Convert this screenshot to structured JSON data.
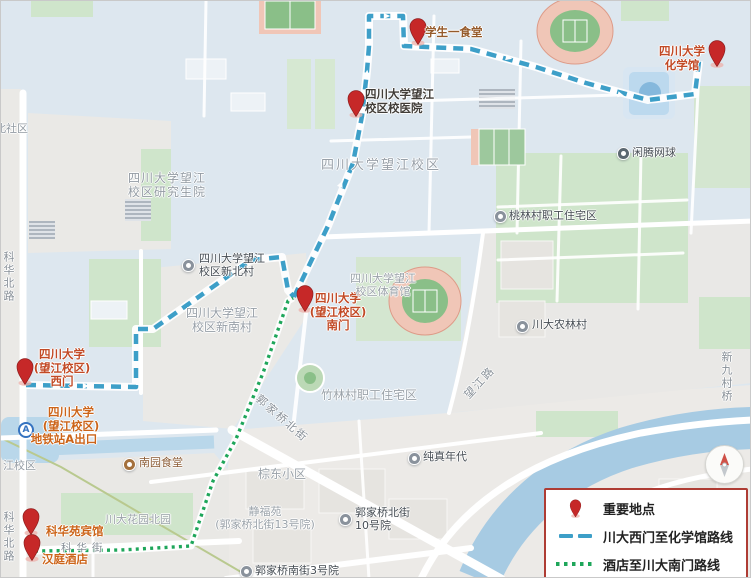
{
  "colors": {
    "route_blue": "#3d9fc8",
    "route_green": "#1ea65a",
    "pin_red": "#c62828",
    "legend_border": "#ae3c34",
    "water": "#a7cbe3",
    "green_area": "#cfe5cb",
    "campus_bg": "#dde7ef"
  },
  "legend": {
    "items": [
      {
        "label": "重要地点"
      },
      {
        "label": "川大西门至化学馆路线"
      },
      {
        "label": "酒店至川大南门路线"
      }
    ]
  },
  "pins": {
    "canteen": {
      "label": "学生一食堂"
    },
    "chemistry": {
      "line1": "四川大学",
      "line2": "化学馆"
    },
    "hospital": {
      "line1": "四川大学望江",
      "line2": "校区校医院"
    },
    "south_gate": {
      "line1": "四川大学",
      "line2": "(望江校区)",
      "line3": "南门"
    },
    "west_gate": {
      "line1": "四川大学",
      "line2": "(望江校区)",
      "line3": "西门"
    },
    "kehuayuan_hotel": {
      "label": "科华苑宾馆"
    },
    "hanting_hotel": {
      "label": "汉庭酒店"
    }
  },
  "metro": {
    "badge": "A",
    "line1": "四川大学",
    "line2": "(望江校区)",
    "line3": "地铁站A出口"
  },
  "poi": {
    "xinbeicun": {
      "line1": "四川大学望江",
      "line2": "校区新北村"
    },
    "taolincun": {
      "label": "桃林村职工住宅区"
    },
    "xianteng": {
      "label": "闲腾网球"
    },
    "nonglincun": {
      "label": "川大农林村"
    },
    "chunzhen": {
      "label": "纯真年代"
    },
    "shihaoyuan": {
      "line1": "郭家桥北街",
      "line2": "10号院"
    },
    "sanhaoyuan": {
      "label": "郭家桥南街3号院"
    },
    "nanyuan": {
      "label": "南园食堂"
    }
  },
  "areas": {
    "graduate": {
      "line1": "四川大学望江",
      "line2": "校区研究生院"
    },
    "campus": {
      "label": "四川大学望江校区"
    },
    "xinnancun": {
      "line1": "四川大学望江",
      "line2": "校区新南村"
    },
    "gym": {
      "line1": "四川大学望江",
      "line2": "校区体育馆"
    },
    "zhulincun": {
      "label": "竹林村职工住宅区"
    },
    "zongdong": {
      "label": "棕东小区"
    },
    "jingfuyuan": {
      "line1": "静福苑",
      "line2": "(郭家桥北街13号院)"
    },
    "huayuan": {
      "label": "川大花园北园"
    },
    "beishequ": {
      "label": "北社区"
    },
    "jiangxiaoqu": {
      "label": "江校区"
    }
  },
  "road_labels": {
    "kehua_north_1": {
      "label": "科华北路"
    },
    "kehua_north_2": {
      "label": "科华北路"
    },
    "guojiaqiao_north": {
      "label": "郭家桥北街"
    },
    "wangjiang_road": {
      "label": "望江路"
    },
    "kehua_street": {
      "label": "科华街"
    },
    "xinjiucun_bridge": {
      "label": "新九村桥"
    }
  }
}
